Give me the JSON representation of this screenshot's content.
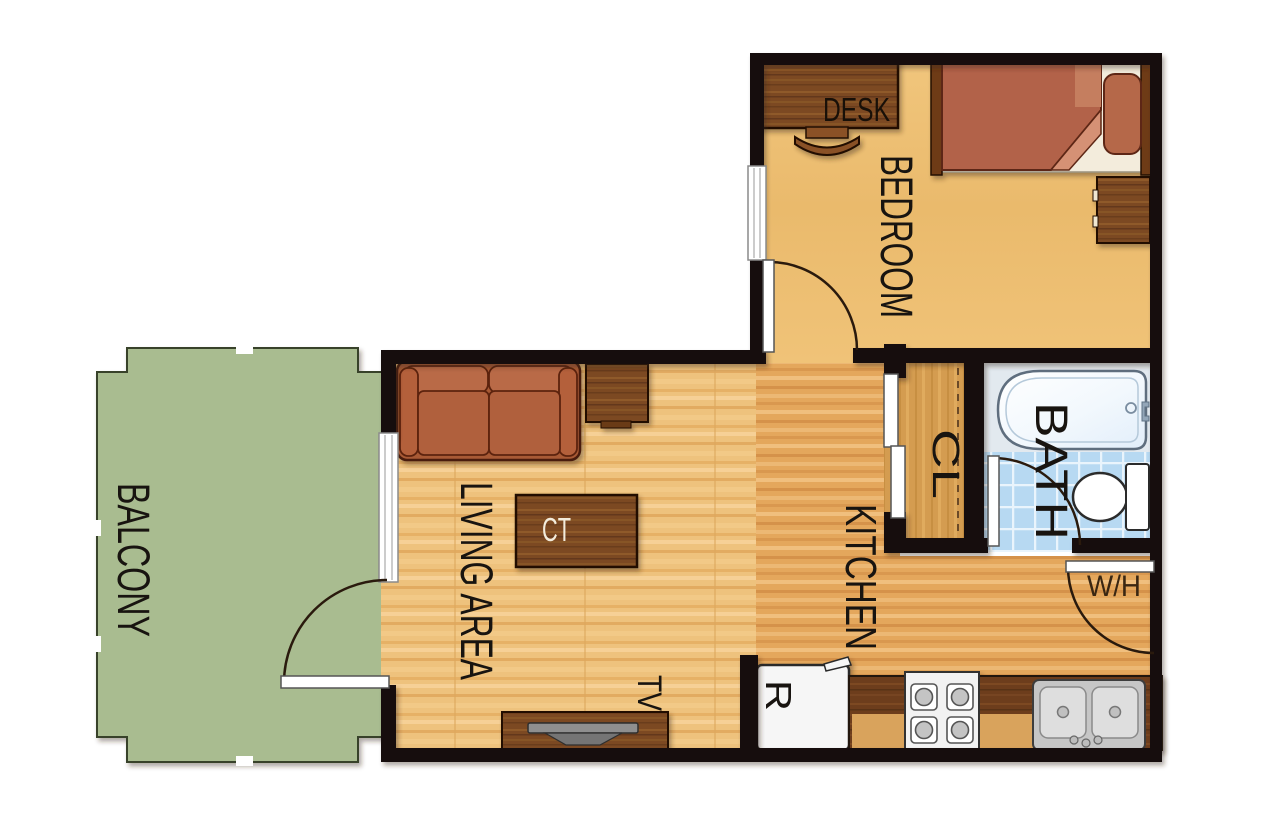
{
  "rooms": {
    "bedroom": {
      "label": "BEDROOM"
    },
    "bath": {
      "label": "BATH"
    },
    "closet": {
      "label": "CL"
    },
    "kitchen": {
      "label": "KITCHEN"
    },
    "living": {
      "label": "LIVING AREA"
    },
    "balcony": {
      "label": "BALCONY"
    }
  },
  "furniture": {
    "desk": {
      "label": "DESK"
    },
    "coffee_table": {
      "label": "CT"
    },
    "tv": {
      "label": "TV"
    },
    "refrigerator": {
      "label": "R"
    },
    "water_heater": {
      "label": "W/H"
    }
  },
  "palette": {
    "wall": "#171008",
    "balcony_floor": "#a9bc90",
    "bedroom_floor": "#eec173",
    "living_floor": "#eec27d",
    "kitchen_floor": "#e4a75c",
    "closet_floor": "#d49c50",
    "furniture_wood": "#7b4a24",
    "counter_wood": "#6d3d1b",
    "upholstery": "#b0613d",
    "bath_tile": "#b7d9f2",
    "fixture_white": "#f6f6f6"
  }
}
